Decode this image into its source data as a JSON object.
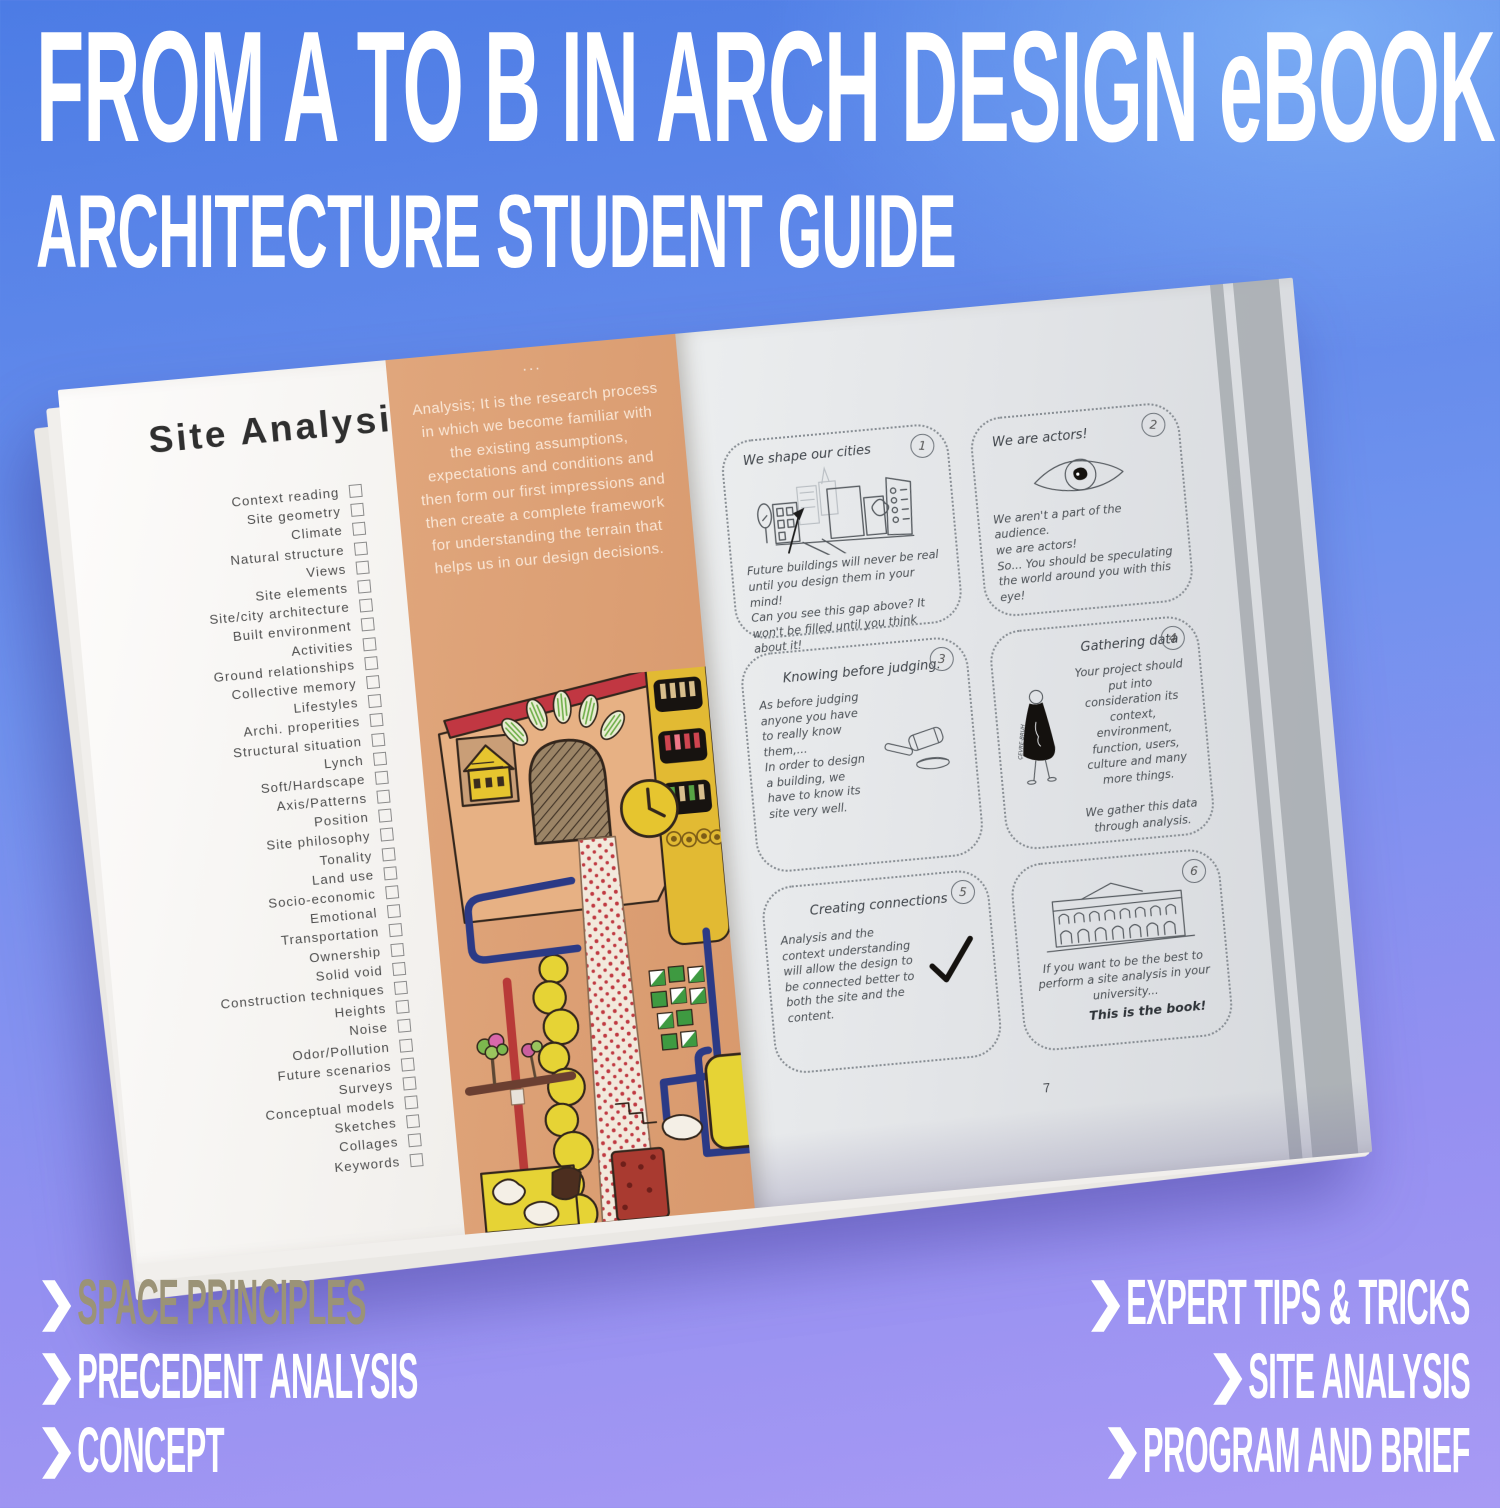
{
  "poster": {
    "title": "FROM A TO B IN ARCH DESIGN eBOOK",
    "subtitle": "ARCHITECTURE STUDENT GUIDE",
    "chevron_glyph": "❯",
    "features_left": [
      {
        "label": "SPACE PRINCIPLES",
        "color": "#9b9377"
      },
      {
        "label": "PRECEDENT ANALYSIS",
        "color": "#ffffff"
      },
      {
        "label": "CONCEPT",
        "color": "#ffffff"
      }
    ],
    "features_right": [
      {
        "label": "EXPERT TIPS & TRICKS",
        "color": "#ffffff"
      },
      {
        "label": "SITE ANALYSIS",
        "color": "#ffffff"
      },
      {
        "label": "PROGRAM AND BRIEF",
        "color": "#ffffff"
      }
    ],
    "background": {
      "top": "#4c7ce5",
      "bottom": "#a89af4"
    }
  },
  "book": {
    "left_page": {
      "heading": "Site Analysis",
      "checklist": [
        "Context reading",
        "Site geometry",
        "Climate",
        "Natural structure",
        "Views",
        "Site elements",
        "Site/city architecture",
        "Built environment",
        "Activities",
        "Ground relationships",
        "Collective memory",
        "Lifestyles",
        "Archi. properities",
        "Structural situation",
        "Lynch",
        "Soft/Hardscape",
        "Axis/Patterns",
        "Position",
        "Site philosophy",
        "Tonality",
        "Land use",
        "Socio-economic",
        "Emotional",
        "Transportation",
        "Ownership",
        "Solid void",
        "Construction techniques",
        "Heights",
        "Noise",
        "Odor/Pollution",
        "Future scenarios",
        "Surveys",
        "Conceptual models",
        "Sketches",
        "Collages",
        "Keywords"
      ],
      "ellipsis": "...",
      "intro_text": "Analysis; It is the research process in which we become familiar with the existing assumptions, expectations and conditions and then form our first impressions and then create a complete framework for understanding the terrain that helps us in our design decisions.",
      "panel_color": "#dc9e74"
    },
    "right_page": {
      "page_number": "7",
      "panels": [
        {
          "number": "1",
          "title": "We shape our cities",
          "body": "Future buildings will never be real until you design them in your mind!\nCan you see this gap above? It won't be filled until you think about it!"
        },
        {
          "number": "2",
          "title": "We are actors!",
          "body": "We aren't a part of the audience.\nwe are actors!\nSo... You should be speculating the world around you with this eye!"
        },
        {
          "number": "3",
          "title": "Knowing before judging.",
          "body": "As before judging anyone you have to really know them,...\nIn order to design a building, we have to know its site very well."
        },
        {
          "number": "4",
          "title": "Gathering data",
          "body": "Your project should put into consideration its context, environment, function, users, culture and many more things.\n\nWe gather this data through analysis.",
          "figure_label": "ÇEVRE-BRUH"
        },
        {
          "number": "5",
          "title": "Creating connections",
          "body": "Analysis and the context understanding will allow the design to be connected better to both the site and the content."
        },
        {
          "number": "6",
          "title": "",
          "body": "If you want to be the best to perform a site analysis in your university...",
          "emphasis": "This is the book!"
        }
      ]
    }
  }
}
